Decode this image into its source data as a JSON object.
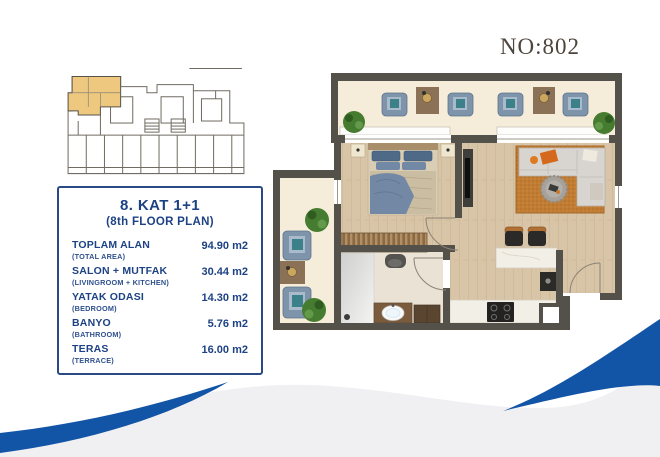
{
  "page": {
    "unit_number": "NO:802"
  },
  "info_box": {
    "title": "8. KAT 1+1",
    "subtitle": "(8th FLOOR PLAN)",
    "rows": [
      {
        "label": "TOPLAM ALAN",
        "sublabel": "(TOTAL AREA)",
        "value": "94.90 m2"
      },
      {
        "label": "SALON + MUTFAK",
        "sublabel": "(LIVINGROOM + KITCHEN)",
        "value": "30.44 m2"
      },
      {
        "label": "YATAK ODASI",
        "sublabel": "(BEDROOM)",
        "value": "14.30 m2"
      },
      {
        "label": "BANYO",
        "sublabel": "(BATHROOM)",
        "value": "5.76 m2"
      },
      {
        "label": "TERAS",
        "sublabel": "(TERRACE)",
        "value": "16.00 m2"
      }
    ]
  },
  "colors": {
    "navy_text": "#1d4284",
    "box_border": "#2a4a85",
    "unit_number_text": "#4d453c",
    "swoosh_blue": "#1254a6",
    "wave_gray": "#f0f0f2",
    "keyplan_highlight": "#edc87e",
    "plan_wall": "#54514b",
    "wood_floor": "#d8c4a6",
    "terrace_floor": "#f5edda",
    "bathroom_floor": "#eae3d5",
    "rug_orange": "#c07c33",
    "armchair_blue": "#7e94ab",
    "sofa_gray": "#d8d5d1",
    "plant_green": "#467c2f",
    "counter_marble": "#f2efe7"
  }
}
